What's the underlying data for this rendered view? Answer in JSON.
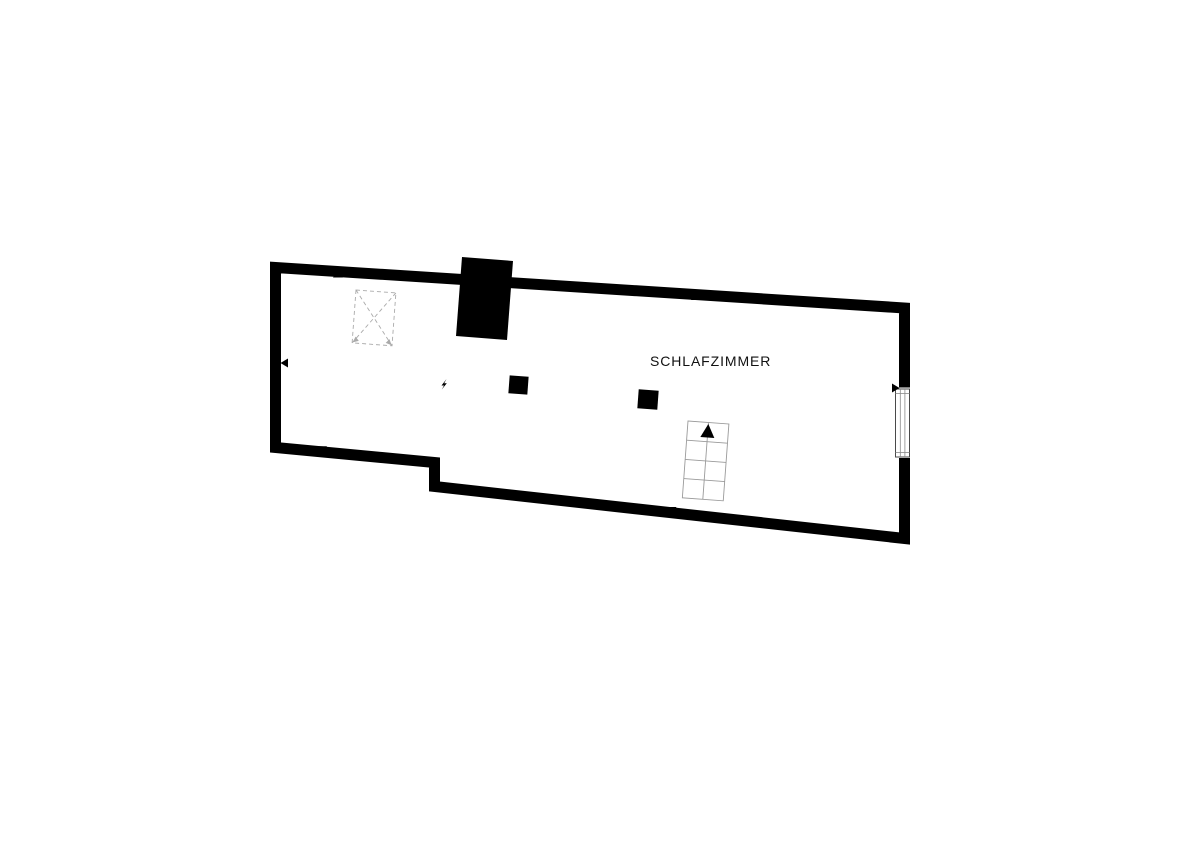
{
  "floor_plan": {
    "room_label": "SCHLAFZIMMER",
    "colors": {
      "walls": "#000000",
      "background": "#ffffff",
      "symbol_gray": "#9a9a9a",
      "dashed_gray": "#aaaaaa",
      "text": "#111111"
    },
    "symbols": {
      "roof_window": "dashed-rect-with-x-diagonals",
      "chimney": "solid-black-block",
      "columns": 2,
      "staircase": "2x4-tread-grid-with-up-arrow",
      "window": "right-wall-window",
      "wall_markers": 6,
      "bolt_marker": 1
    }
  }
}
